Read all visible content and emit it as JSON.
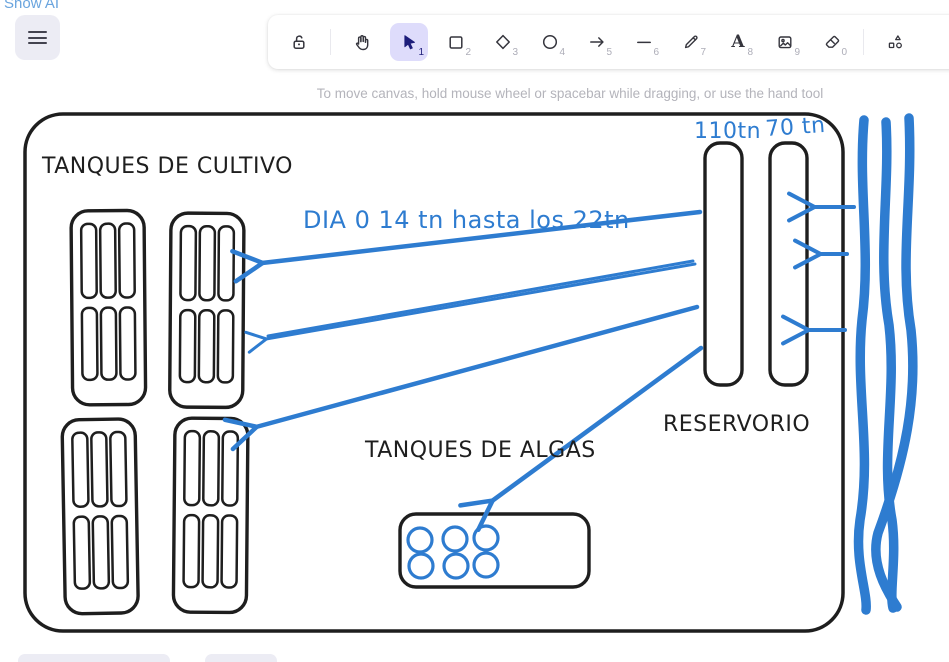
{
  "page": {
    "show_ai_label": "Show AI",
    "helper_text": "To move canvas, hold mouse wheel or spacebar while dragging, or use the hand tool"
  },
  "toolbar": {
    "tools": [
      {
        "name": "lock",
        "icon": "unlocked-padlock-icon",
        "badge": ""
      },
      {
        "name": "hand",
        "icon": "hand-icon",
        "badge": ""
      },
      {
        "name": "selection",
        "icon": "cursor-arrow-icon",
        "badge": "1",
        "active": true
      },
      {
        "name": "rectangle",
        "icon": "square-icon",
        "badge": "2"
      },
      {
        "name": "diamond",
        "icon": "diamond-icon",
        "badge": "3"
      },
      {
        "name": "ellipse",
        "icon": "circle-icon",
        "badge": "4"
      },
      {
        "name": "arrow",
        "icon": "arrow-right-icon",
        "badge": "5"
      },
      {
        "name": "line",
        "icon": "line-icon",
        "badge": "6"
      },
      {
        "name": "draw",
        "icon": "pencil-icon",
        "badge": "7"
      },
      {
        "name": "text",
        "icon": "letter-a-icon",
        "badge": "8"
      },
      {
        "name": "image",
        "icon": "image-icon",
        "badge": "9"
      },
      {
        "name": "eraser",
        "icon": "eraser-icon",
        "badge": "0"
      },
      {
        "name": "more-shapes",
        "icon": "shapes-icon",
        "badge": ""
      }
    ]
  },
  "menu": {
    "icon": "hamburger-icon"
  },
  "canvas": {
    "labels": {
      "cultivo": "TANQUES DE CULTIVO",
      "dia": "DIA 0 14 tn hasta los 22tn",
      "capacity_110": "110tn",
      "capacity_70": "70 tn",
      "algas": "TANQUES DE ALGAS",
      "reservorio": "RESERVORIO"
    },
    "colors": {
      "ink": "#1e1e1e",
      "draw_blue": "#2e7cd0",
      "active_tool_bg": "#dedcfb",
      "active_tool_fg": "#1d1d7a",
      "link_blue": "#69a4de"
    }
  }
}
